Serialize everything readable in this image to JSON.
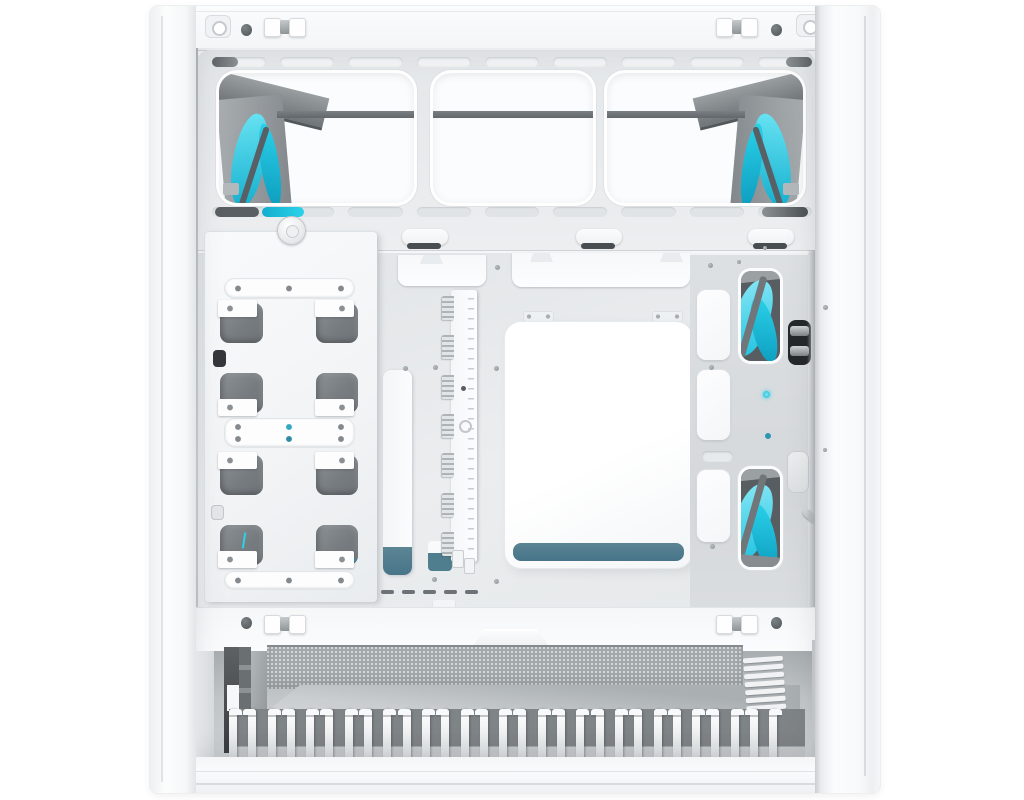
{
  "meta": {
    "description": "Product photo of a white mid-tower PC case, side panel removed, cable-management side view. Cyan-bladed fans are visible through the top fan bracket cutouts and through two vertical cutouts on the right wall. A white drive-mount plate sits on the left, a vertical fan/ARGB hub PCB in the center, a large white access panel with a slate-teal lower edge in the middle, a mesh PSU dust filter and a long row of white cable-comb teeth along the bottom.",
    "type": "product-photo",
    "visible_text": ""
  },
  "colors": {
    "background": "#ffffff",
    "case_white": "#f7f8f9",
    "panel_bright": "#fdfdfe",
    "frame_line": "#d9dcde",
    "interior_gray": "#e8eaeb",
    "interior_deep": "#dcdfe1",
    "cutout_white": "#fbfcfd",
    "steel_gray": "#787d81",
    "dark_slot": "#43484c",
    "near_black": "#26292c",
    "accent_cyan": "#2bd2ea",
    "cyan_deep": "#12aecd",
    "slate_teal": "#4f7e8e",
    "mesh_gray": "#a2a7aa",
    "mesh_dot": "#d6d9db",
    "floor_gray": "#ced2d4",
    "teeth_white": "#f4f6f7",
    "teeth_gap": "#878c8f"
  },
  "counts": {
    "top_fan_cutouts": 3,
    "visible_fan_glimpses": 4,
    "top_vent_slots": 9,
    "lower_vent_slots": 9,
    "cable_hooks": 3,
    "drive_mount_rows": 4,
    "hub_connector_blocks": 7,
    "right_wall_covers": 3,
    "psu_vent_dashes": 5,
    "right_comb_bars": 8,
    "cable_comb_teeth": 29
  }
}
